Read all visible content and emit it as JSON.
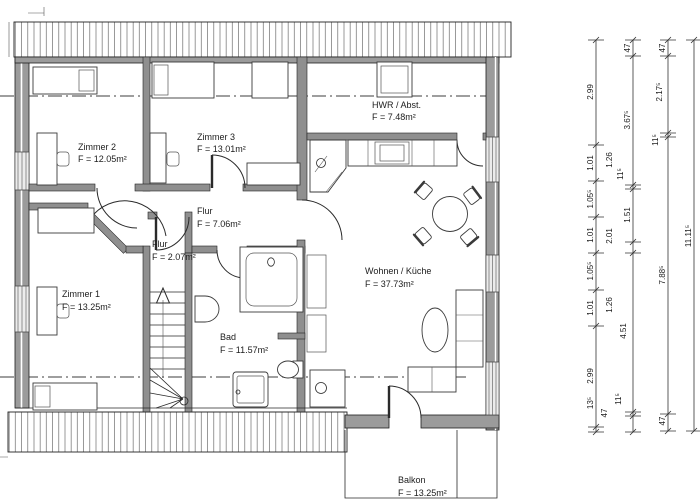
{
  "drawing": {
    "type": "floor-plan",
    "language": "de"
  },
  "rooms": [
    {
      "id": "zimmer2",
      "name": "Zimmer 2",
      "area": "F = 12.05m²"
    },
    {
      "id": "zimmer3",
      "name": "Zimmer 3",
      "area": "F = 13.01m²"
    },
    {
      "id": "flur",
      "name": "Flur",
      "area": "F = 7.06m²"
    },
    {
      "id": "hwr",
      "name": "HWR / Abst.",
      "area": "F = 7.48m²"
    },
    {
      "id": "zimmer1",
      "name": "Zimmer 1",
      "area": "F = 13.25m²"
    },
    {
      "id": "flur2",
      "name": "Flur",
      "area": "F = 2.07m²"
    },
    {
      "id": "bad",
      "name": "Bad",
      "area": "F = 11.57m²"
    },
    {
      "id": "wohnen",
      "name": "Wohnen / Küche",
      "area": "F = 37.73m²"
    },
    {
      "id": "balkon",
      "name": "Balkon",
      "area": "F = 13.25m²"
    }
  ],
  "dimensions": {
    "chain1": [
      "2.99",
      "1.01",
      "1.05⁵",
      "1.01",
      "1.05⁵",
      "1.01",
      "2.99",
      "13⁵"
    ],
    "chain2": [
      "47",
      "3.67⁵",
      "1.26",
      "11⁵",
      "1.51",
      "2.01",
      "1.26",
      "4.51",
      "11⁵",
      "47"
    ],
    "chain3": [
      "47",
      "2.17⁵",
      "11⁵",
      "7.88⁵",
      "47"
    ],
    "chain4": [
      "11.11⁵"
    ]
  },
  "colors": {
    "wall_fill": "#9b9b9b",
    "line": "#1c1c1c",
    "background": "#ffffff"
  }
}
